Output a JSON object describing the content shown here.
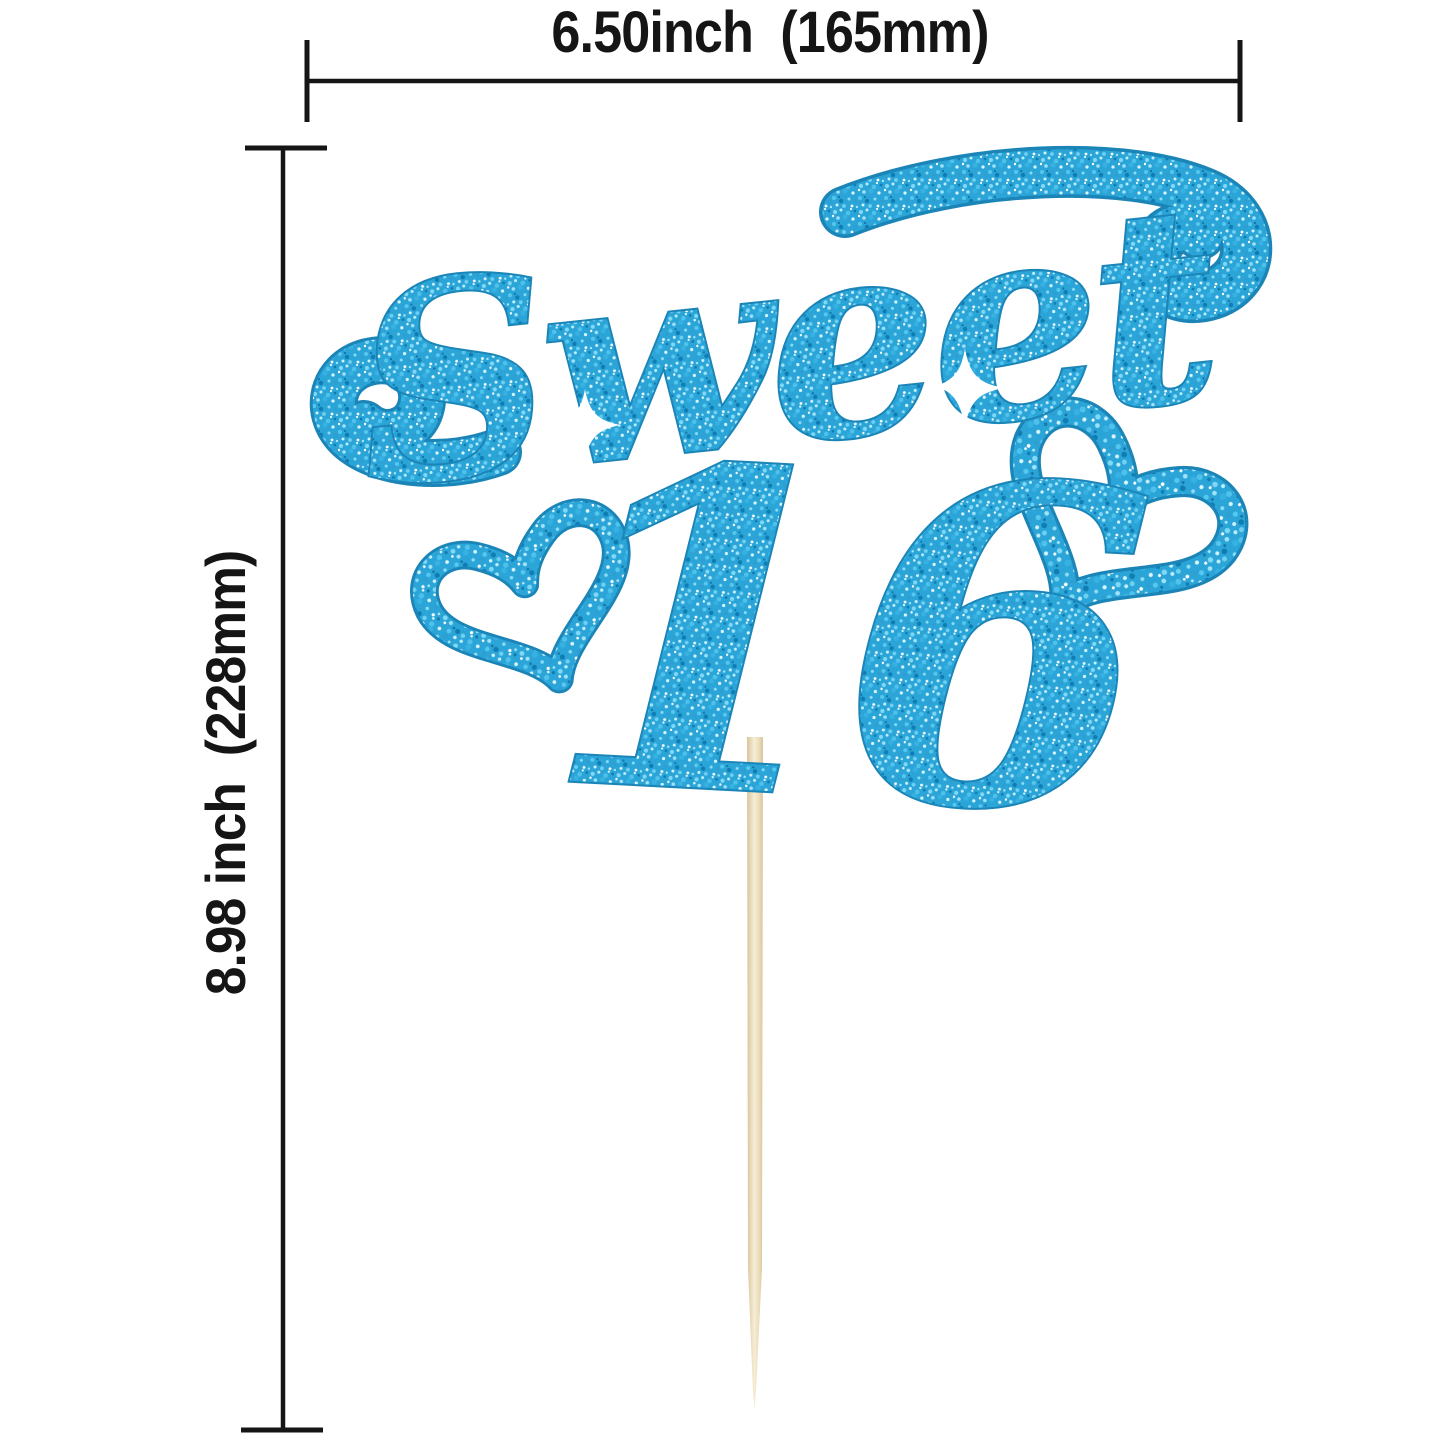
{
  "page": {
    "background_color": "#ffffff"
  },
  "annotations": {
    "width_label": "6.50inch  (165mm)",
    "height_label": "8.98 inch  (228mm)",
    "width_value": {
      "inches": "6.50",
      "mm": "165"
    },
    "height_value": {
      "inches": "8.98",
      "mm": "228"
    },
    "line_color": "#151515"
  },
  "topper": {
    "word": "Sweet",
    "number": "16"
  },
  "colors": {
    "glitter_base": "#2BA5D8",
    "glitter_light": "#7FD8F5",
    "glitter_dark": "#0F7CB2",
    "outline": "#1B85B8",
    "stick_light": "#F6EDD6",
    "stick_mid": "#EBDDBA",
    "stick_dark": "#D8C49A"
  }
}
